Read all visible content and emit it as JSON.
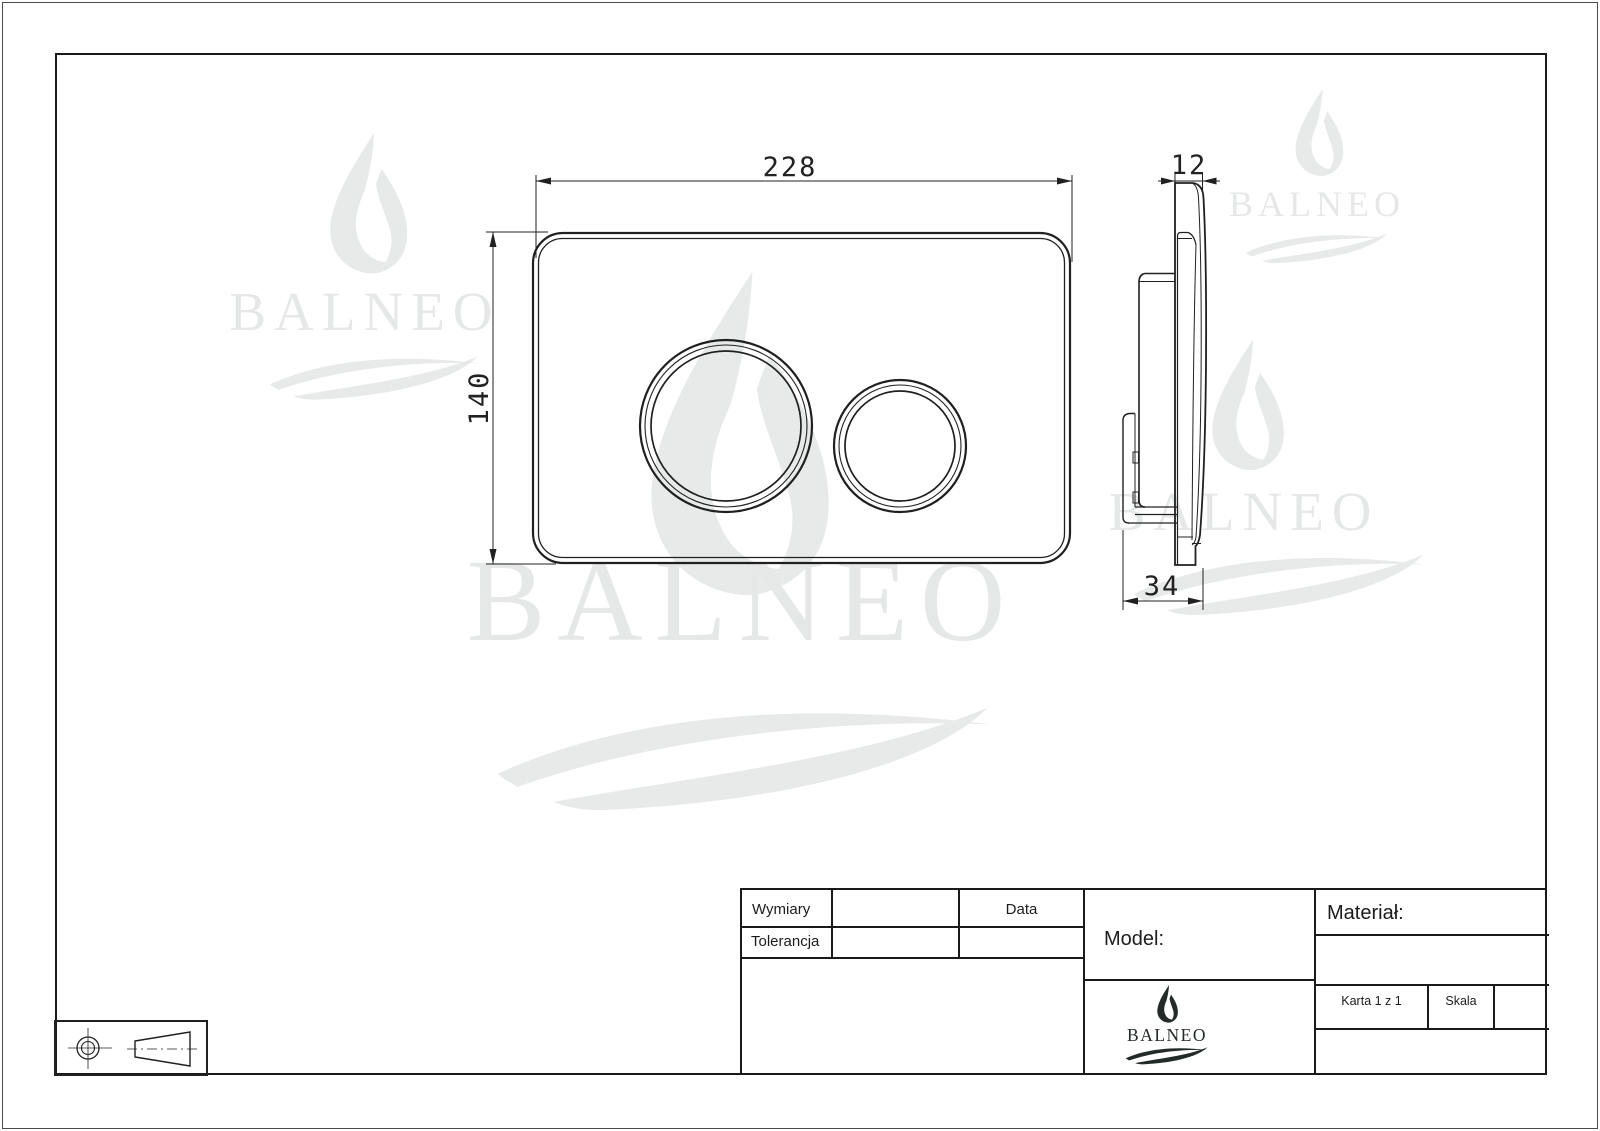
{
  "brand": "BALNEO",
  "drawing": {
    "front_view": {
      "width_mm": "228",
      "height_mm": "140"
    },
    "side_view": {
      "thickness_mm": "12",
      "depth_mm": "34"
    }
  },
  "title_block": {
    "dimensions_label": "Wymiary",
    "tolerance_label": "Tolerancja",
    "date_label": "Data",
    "model_label": "Model:",
    "material_label": "Materiał:",
    "sheet_label": "Karta 1 z 1",
    "scale_label": "Skala",
    "logo_text": "BALNEO"
  }
}
